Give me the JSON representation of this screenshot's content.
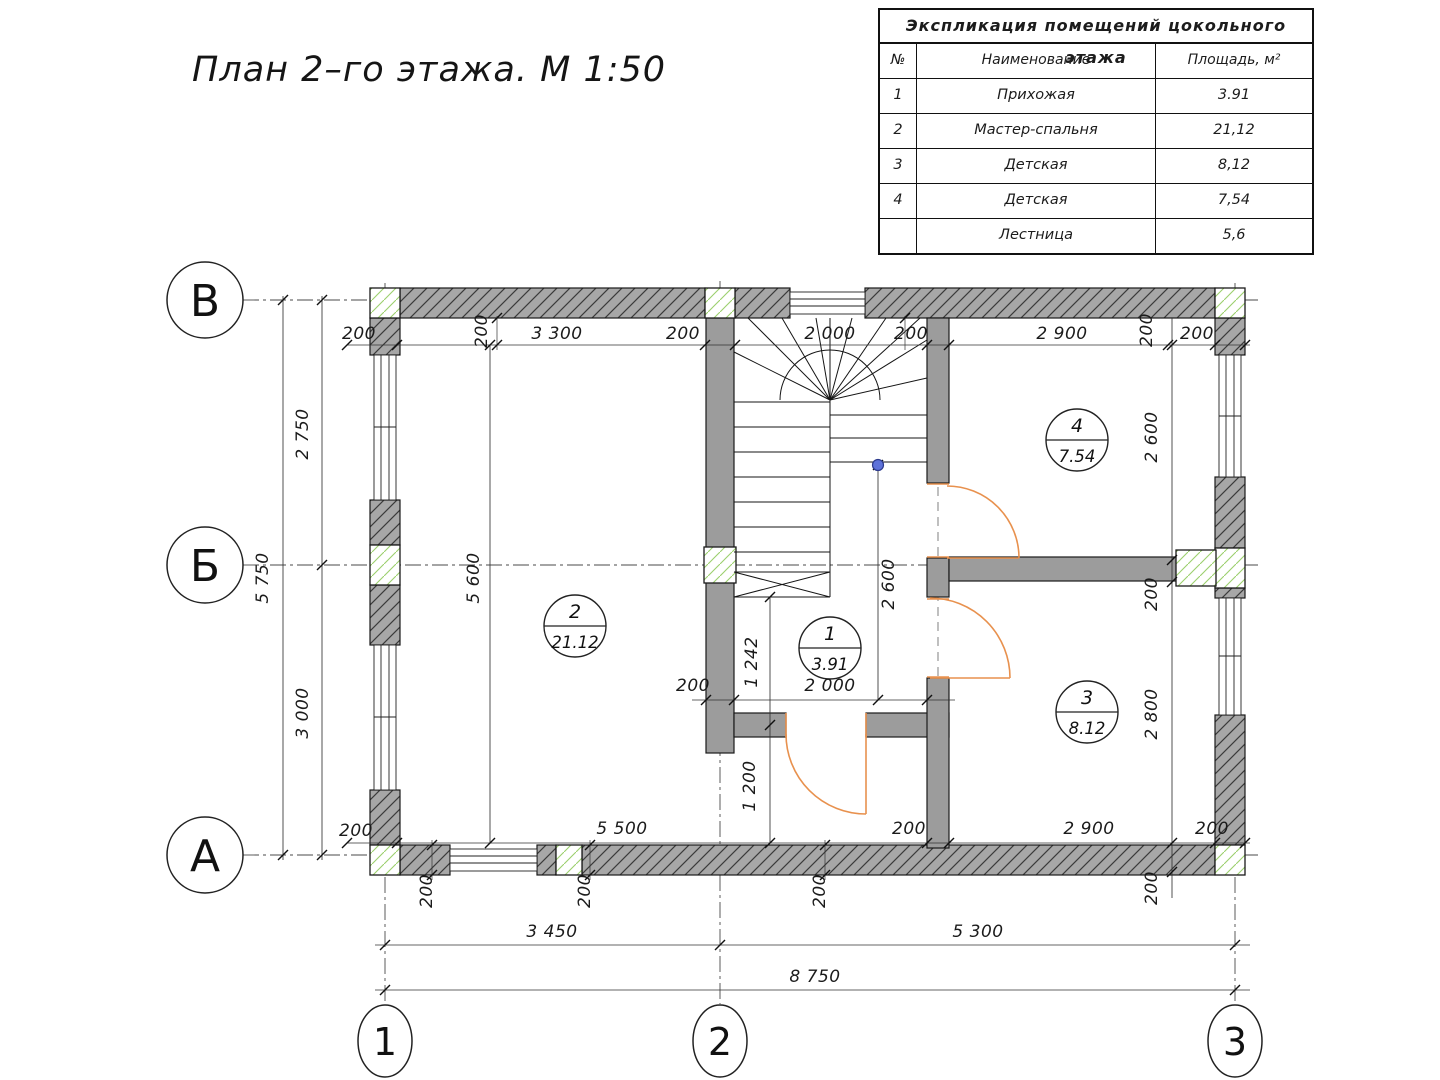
{
  "plan": {
    "title": "План 2–го этажа. М 1:50"
  },
  "table": {
    "title": "Экспликация помещений цокольного этажа",
    "headers": [
      "№",
      "Наименование",
      "Площадь, м²"
    ],
    "rows": [
      [
        "1",
        "Прихожая",
        "3.91"
      ],
      [
        "2",
        "Мастер-спальня",
        "21,12"
      ],
      [
        "3",
        "Детская",
        "8,12"
      ],
      [
        "4",
        "Детская",
        "7,54"
      ],
      [
        "",
        "Лестница",
        "5,6"
      ]
    ]
  },
  "axes": {
    "left": [
      {
        "label": "В",
        "x": 205,
        "y": 300
      },
      {
        "label": "Б",
        "x": 205,
        "y": 565
      },
      {
        "label": "А",
        "x": 205,
        "y": 855
      }
    ],
    "bottom": [
      {
        "label": "1",
        "x": 385,
        "y": 1041
      },
      {
        "label": "2",
        "x": 720,
        "y": 1041
      },
      {
        "label": "3",
        "x": 1235,
        "y": 1041
      }
    ]
  },
  "rooms": [
    {
      "num": "1",
      "area": "3.91",
      "x": 830,
      "y": 648
    },
    {
      "num": "2",
      "area": "21.12",
      "x": 575,
      "y": 626
    },
    {
      "num": "3",
      "area": "8.12",
      "x": 1087,
      "y": 712
    },
    {
      "num": "4",
      "area": "7.54",
      "x": 1077,
      "y": 440
    }
  ],
  "dim_labels": [
    {
      "t": "200",
      "x": 359,
      "y": 339
    },
    {
      "t": "200",
      "x": 487,
      "y": 331,
      "r": 1
    },
    {
      "t": "3 300",
      "x": 557,
      "y": 339
    },
    {
      "t": "200",
      "x": 683,
      "y": 339
    },
    {
      "t": "2 000",
      "x": 830,
      "y": 339
    },
    {
      "t": "200",
      "x": 911,
      "y": 339
    },
    {
      "t": "2 900",
      "x": 1062,
      "y": 339
    },
    {
      "t": "200",
      "x": 1152,
      "y": 330,
      "r": 1
    },
    {
      "t": "200",
      "x": 1197,
      "y": 339
    },
    {
      "t": "2 750",
      "x": 308,
      "y": 434,
      "r": 1
    },
    {
      "t": "3 000",
      "x": 308,
      "y": 713,
      "r": 1
    },
    {
      "t": "5 750",
      "x": 268,
      "y": 578,
      "r": 1
    },
    {
      "t": "5 600",
      "x": 479,
      "y": 578,
      "r": 1
    },
    {
      "t": "200",
      "x": 693,
      "y": 691
    },
    {
      "t": "2 000",
      "x": 830,
      "y": 691
    },
    {
      "t": "1 242",
      "x": 757,
      "y": 662,
      "r": 1
    },
    {
      "t": "1 200",
      "x": 755,
      "y": 786,
      "r": 1
    },
    {
      "t": "2 600",
      "x": 894,
      "y": 584,
      "r": 1
    },
    {
      "t": "2 600",
      "x": 1157,
      "y": 437,
      "r": 1
    },
    {
      "t": "200",
      "x": 1157,
      "y": 594,
      "r": 1
    },
    {
      "t": "2 800",
      "x": 1157,
      "y": 714,
      "r": 1
    },
    {
      "t": "200",
      "x": 1157,
      "y": 888,
      "r": 1
    },
    {
      "t": "200",
      "x": 356,
      "y": 836
    },
    {
      "t": "5 500",
      "x": 622,
      "y": 834
    },
    {
      "t": "200",
      "x": 909,
      "y": 834
    },
    {
      "t": "2 900",
      "x": 1089,
      "y": 834
    },
    {
      "t": "200",
      "x": 1212,
      "y": 834
    },
    {
      "t": "200",
      "x": 432,
      "y": 891,
      "r": 1
    },
    {
      "t": "200",
      "x": 590,
      "y": 891,
      "r": 1
    },
    {
      "t": "200",
      "x": 825,
      "y": 891,
      "r": 1
    },
    {
      "t": "3 450",
      "x": 552,
      "y": 937
    },
    {
      "t": "5 300",
      "x": 978,
      "y": 937
    },
    {
      "t": "8 750",
      "x": 815,
      "y": 982
    }
  ],
  "colors": {
    "door": "#e8914e",
    "wall_fill": "#a7a7a7",
    "wall_hatch": "#3b3b3b",
    "column_hatch": "#9ccf6d",
    "marker_blue": "#5e72d9"
  }
}
